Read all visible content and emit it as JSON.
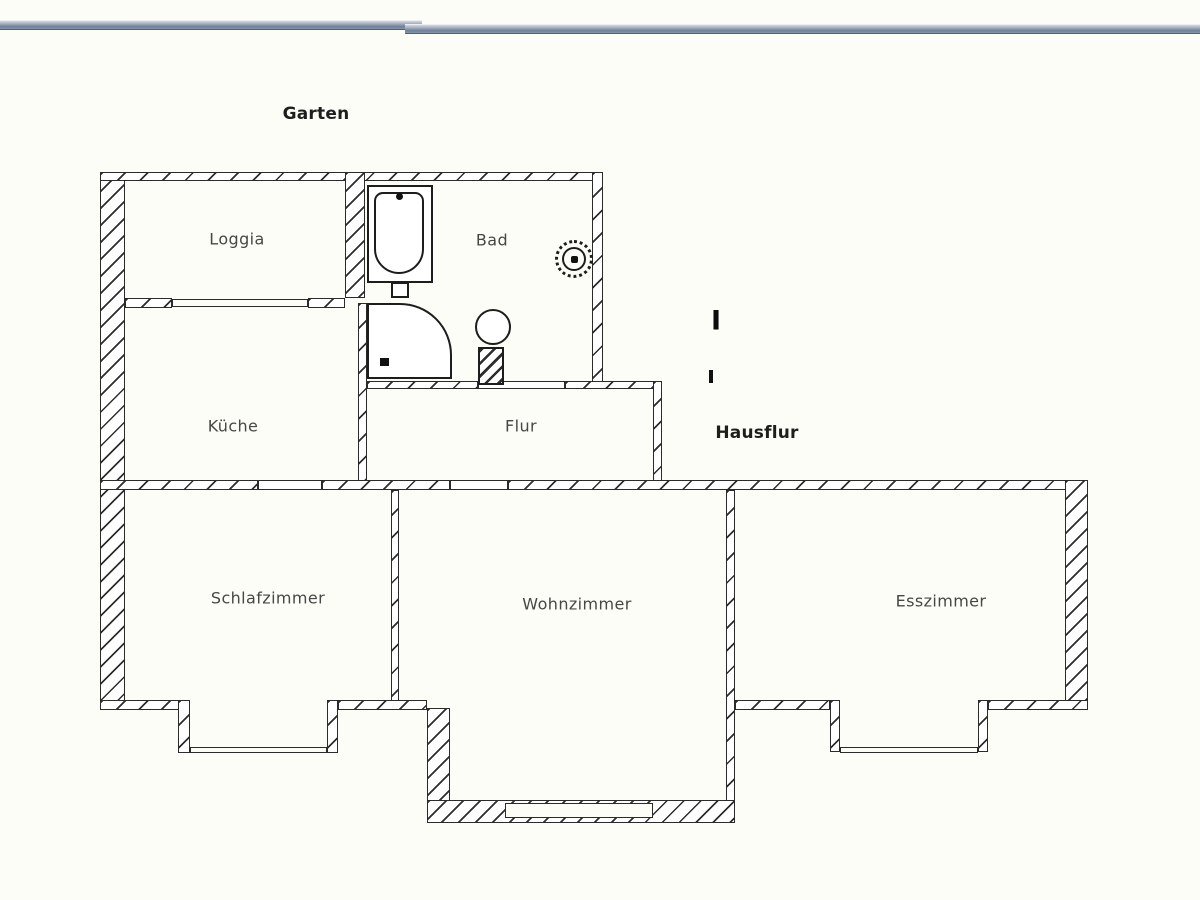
{
  "floorplan": {
    "outside_labels": [
      {
        "id": "garten",
        "text": "Garten"
      },
      {
        "id": "hausflur",
        "text": "Hausflur"
      }
    ],
    "rooms": [
      {
        "id": "loggia",
        "label": "Loggia"
      },
      {
        "id": "bad",
        "label": "Bad"
      },
      {
        "id": "kueche",
        "label": "Küche"
      },
      {
        "id": "flur",
        "label": "Flur"
      },
      {
        "id": "schlafzimmer",
        "label": "Schlafzimmer"
      },
      {
        "id": "wohnzimmer",
        "label": "Wohnzimmer"
      },
      {
        "id": "esszimmer",
        "label": "Esszimmer"
      }
    ],
    "marker": {
      "text": "I"
    },
    "fixtures": [
      "bathtub",
      "sink",
      "shower",
      "wc",
      "floor-drain"
    ],
    "colors": {
      "background": "#fdfdf7",
      "wall_line": "#2b2b2b",
      "room_label": "#474747",
      "bold_label": "#1e1e1e",
      "chrome_bar_light": "#d3d8df",
      "chrome_bar_dark": "#4d6078"
    }
  }
}
